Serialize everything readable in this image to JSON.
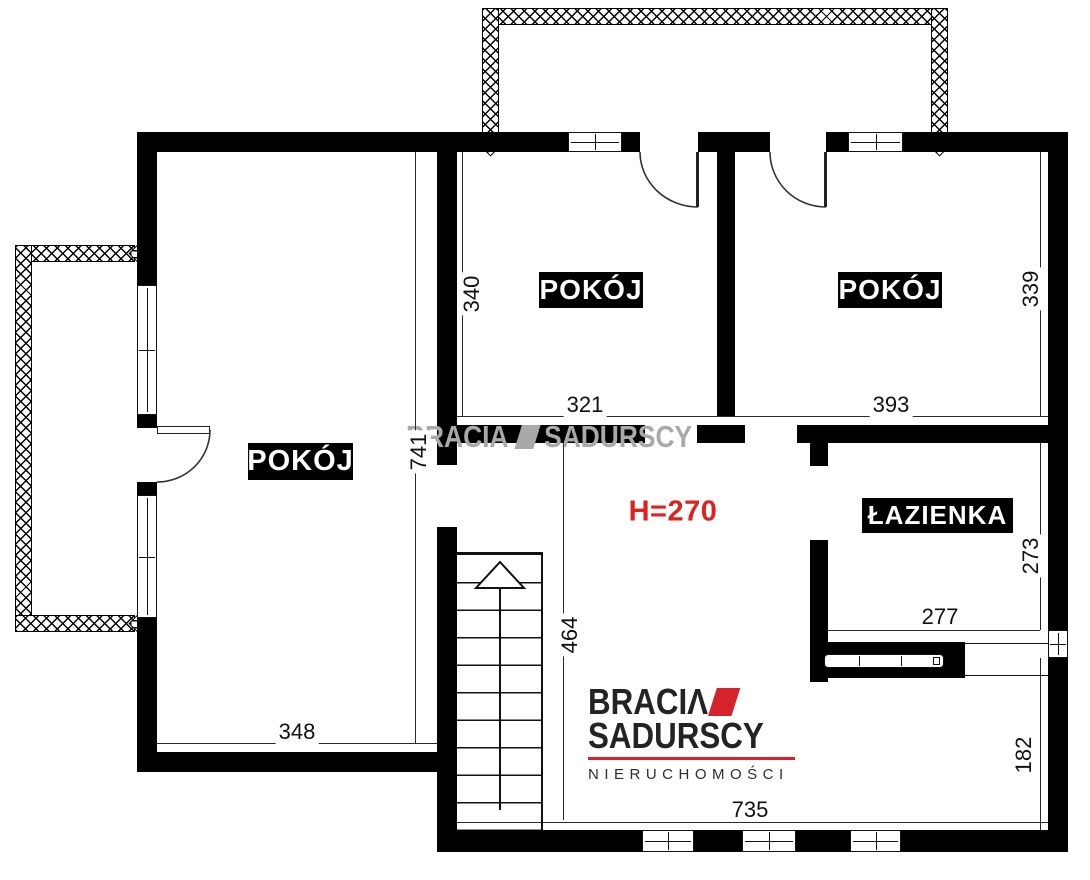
{
  "rooms": {
    "left_label": "POKÓJ",
    "top_center_label": "POKÓJ",
    "top_right_label": "POKÓJ",
    "bathroom_label": "ŁAZIENKA"
  },
  "annotations": {
    "ceiling_height": "H=270"
  },
  "dims": {
    "top_center_height": "340",
    "top_center_width": "321",
    "top_right_width": "393",
    "top_right_height": "339",
    "left_room_height": "741",
    "hall_height": "464",
    "left_room_width": "348",
    "bathroom_width": "277",
    "bathroom_height": "273",
    "hall_width": "735",
    "bottom_room_height": "182"
  },
  "watermark": {
    "word1": "BRACIA",
    "word2": "SADURSCY"
  },
  "logo": {
    "word1_prefix": "BRACI",
    "a_glyph": "Λ",
    "word2": "SADURSCY",
    "tagline": "NIERUCHOMOŚCI"
  },
  "colors": {
    "wall": "#000000",
    "accent_red": "#d5232b",
    "dimension_red": "#dc231f",
    "watermark_gray": "#a9a9a9",
    "logo_text": "#232323"
  }
}
